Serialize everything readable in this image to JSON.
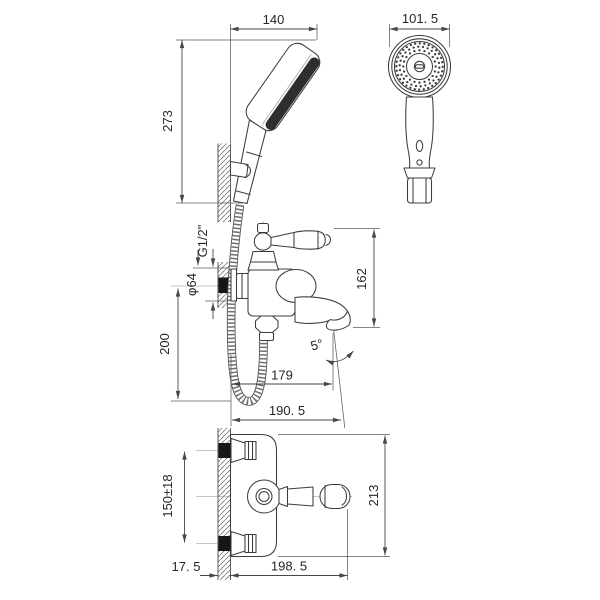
{
  "drawing": {
    "background": "#ffffff",
    "line_color": "#3d3d3d",
    "anchor_fill_color": "#161616",
    "labels": {
      "side_width": "140",
      "side_height": "273",
      "head_diameter": "101. 5",
      "thread": "G1/2\"",
      "escutcheon_diameter": "φ64",
      "mount_height": "200",
      "spout_height": "162",
      "spout_reach": "179",
      "spout_reach_total": "190. 5",
      "spout_angle": "5°",
      "inlet_spacing": "150±18",
      "overall_depth": "213",
      "wall_thickness": "17. 5",
      "overall_length": "198. 5"
    }
  }
}
